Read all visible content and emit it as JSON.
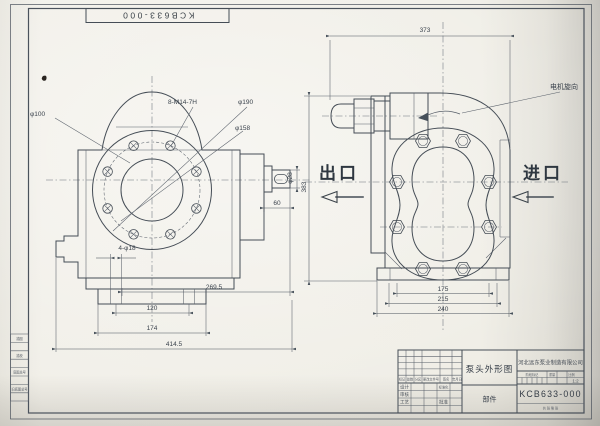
{
  "drawing": {
    "corner_stamp": "KCB633-000",
    "left_view": {
      "dia_100": "φ100",
      "bolt_holes": "8-M14-7H",
      "dia_190": "φ190",
      "dia_158": "φ158",
      "foot_holes": "4-φ18",
      "dim_60": "60",
      "dim_269_5": "269.5",
      "dim_120": "120",
      "dim_174": "174",
      "dim_414_5": "414.5",
      "shaft_dia": "φ28"
    },
    "right_view": {
      "dim_373": "373",
      "dim_383": "383",
      "motor_rotation_label": "电机旋向",
      "outlet_label": "出口",
      "inlet_label": "进口",
      "dim_175": "175",
      "dim_215": "215",
      "dim_240": "240"
    }
  },
  "title_block": {
    "drawing_title": "泵头外形图",
    "part_category": "部件",
    "company": "河北远东泵业制造有限公司",
    "drawing_number": "KCB633-000",
    "scale": "1:2",
    "rev_headers": [
      "标记",
      "处数",
      "分区",
      "更改文件号",
      "签名",
      "年月日"
    ],
    "sign_labels": [
      "设计",
      "标准化",
      "审核",
      "工艺",
      "批准"
    ],
    "stage_headers": [
      "阶段标记",
      "重量",
      "比例"
    ],
    "sheet_note": "共 张 第 张"
  },
  "margin_block": {
    "rows": [
      "描图",
      "描校",
      "底图总号",
      "旧底图总号"
    ]
  }
}
